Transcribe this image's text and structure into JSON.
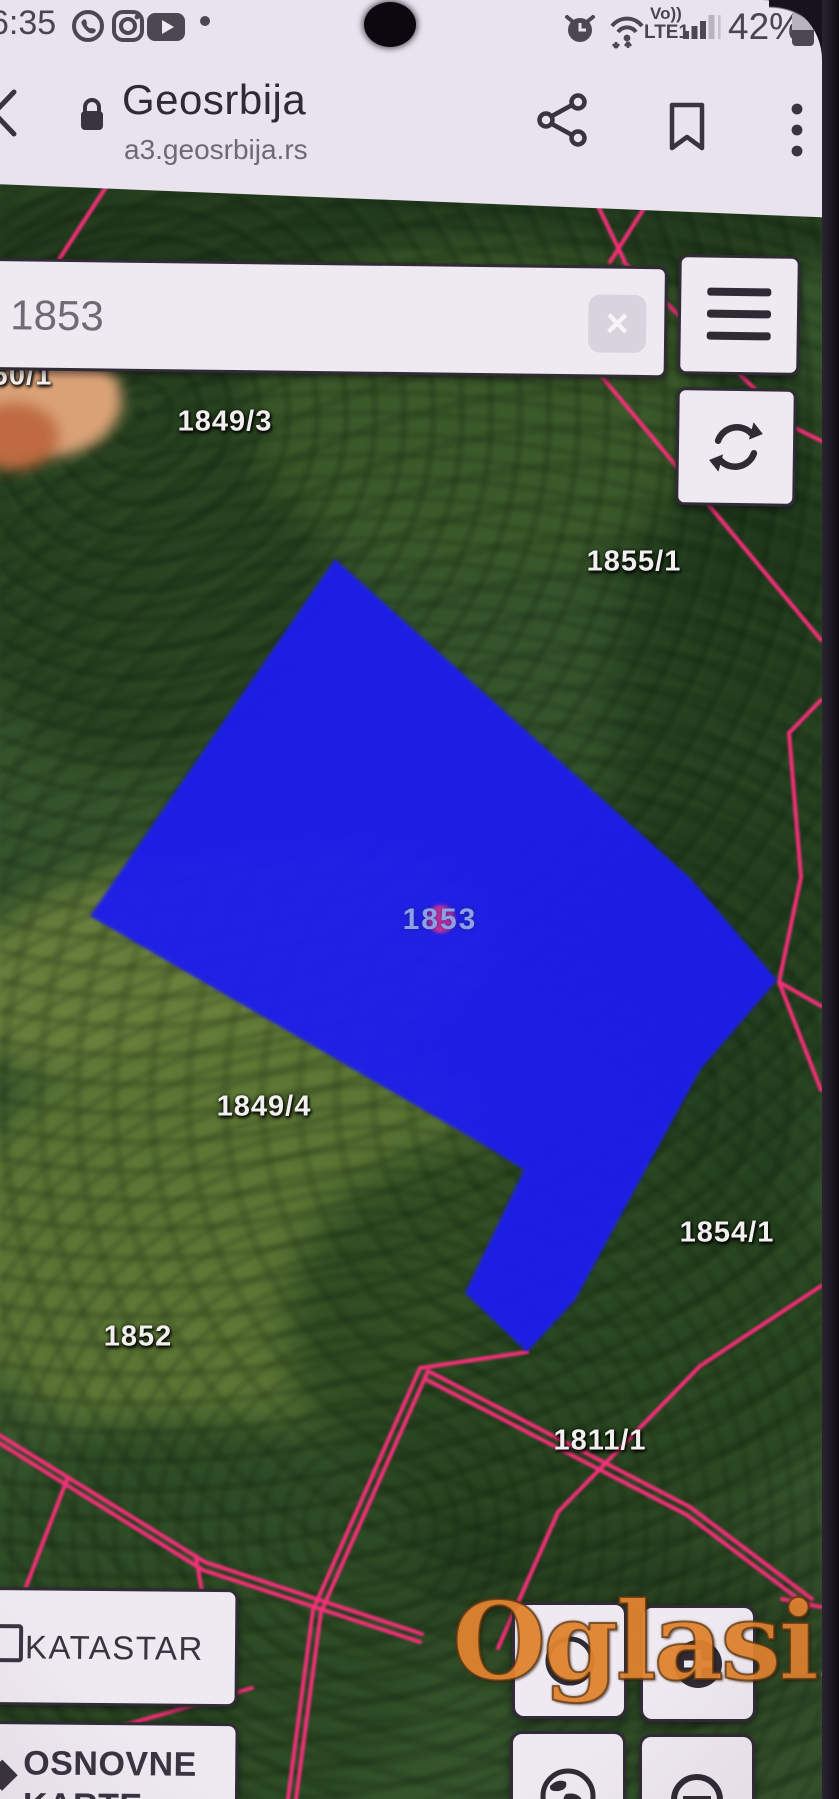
{
  "status_bar": {
    "time": "6:35",
    "battery_percent": "42%",
    "volte_label": "Vo))",
    "network_label": "LTE1",
    "left_icons": [
      "viber-icon",
      "instagram-icon",
      "youtube-icon",
      "notification-dot"
    ],
    "right_icons": [
      "alarm-clock-icon",
      "wifi-icon",
      "signal-bars-icon",
      "battery-icon"
    ]
  },
  "browser_header": {
    "title": "Geosrbija",
    "url": "a3.geosrbija.rs",
    "icons": [
      "back-chevron-icon",
      "lock-icon",
      "share-icon",
      "bookmark-icon",
      "overflow-menu-icon"
    ]
  },
  "search": {
    "value": "1853",
    "clear_glyph": "×"
  },
  "map": {
    "boundary_color": "#ff2f7e",
    "selected_parcel": {
      "number": "1853",
      "fill_color": "#1c1cf0",
      "marker_color": "#c9309b",
      "label_color": "#8d9fe6"
    },
    "labels": [
      {
        "text": "60/1",
        "x": 22,
        "y": 376
      },
      {
        "text": "1849/3",
        "x": 225,
        "y": 422
      },
      {
        "text": "1855/1",
        "x": 634,
        "y": 562
      },
      {
        "text": "1853",
        "x": 440,
        "y": 920,
        "variant": "parcel"
      },
      {
        "text": "1849/4",
        "x": 264,
        "y": 1107
      },
      {
        "text": "1854/1",
        "x": 727,
        "y": 1233
      },
      {
        "text": "1852",
        "x": 138,
        "y": 1337
      },
      {
        "text": "1811/1",
        "x": 600,
        "y": 1441
      }
    ]
  },
  "layer_buttons": {
    "katastar": "KATASTAR",
    "osnovne_line1": "OSNOVNE",
    "osnovne_line2": "KARTE",
    "tool_icons": [
      "compass-circle-icon",
      "crosshair-plus-icon",
      "globe-icon",
      "restricted-icon"
    ]
  },
  "watermark": {
    "text": "Oglasi",
    "suffix": ".rs"
  }
}
